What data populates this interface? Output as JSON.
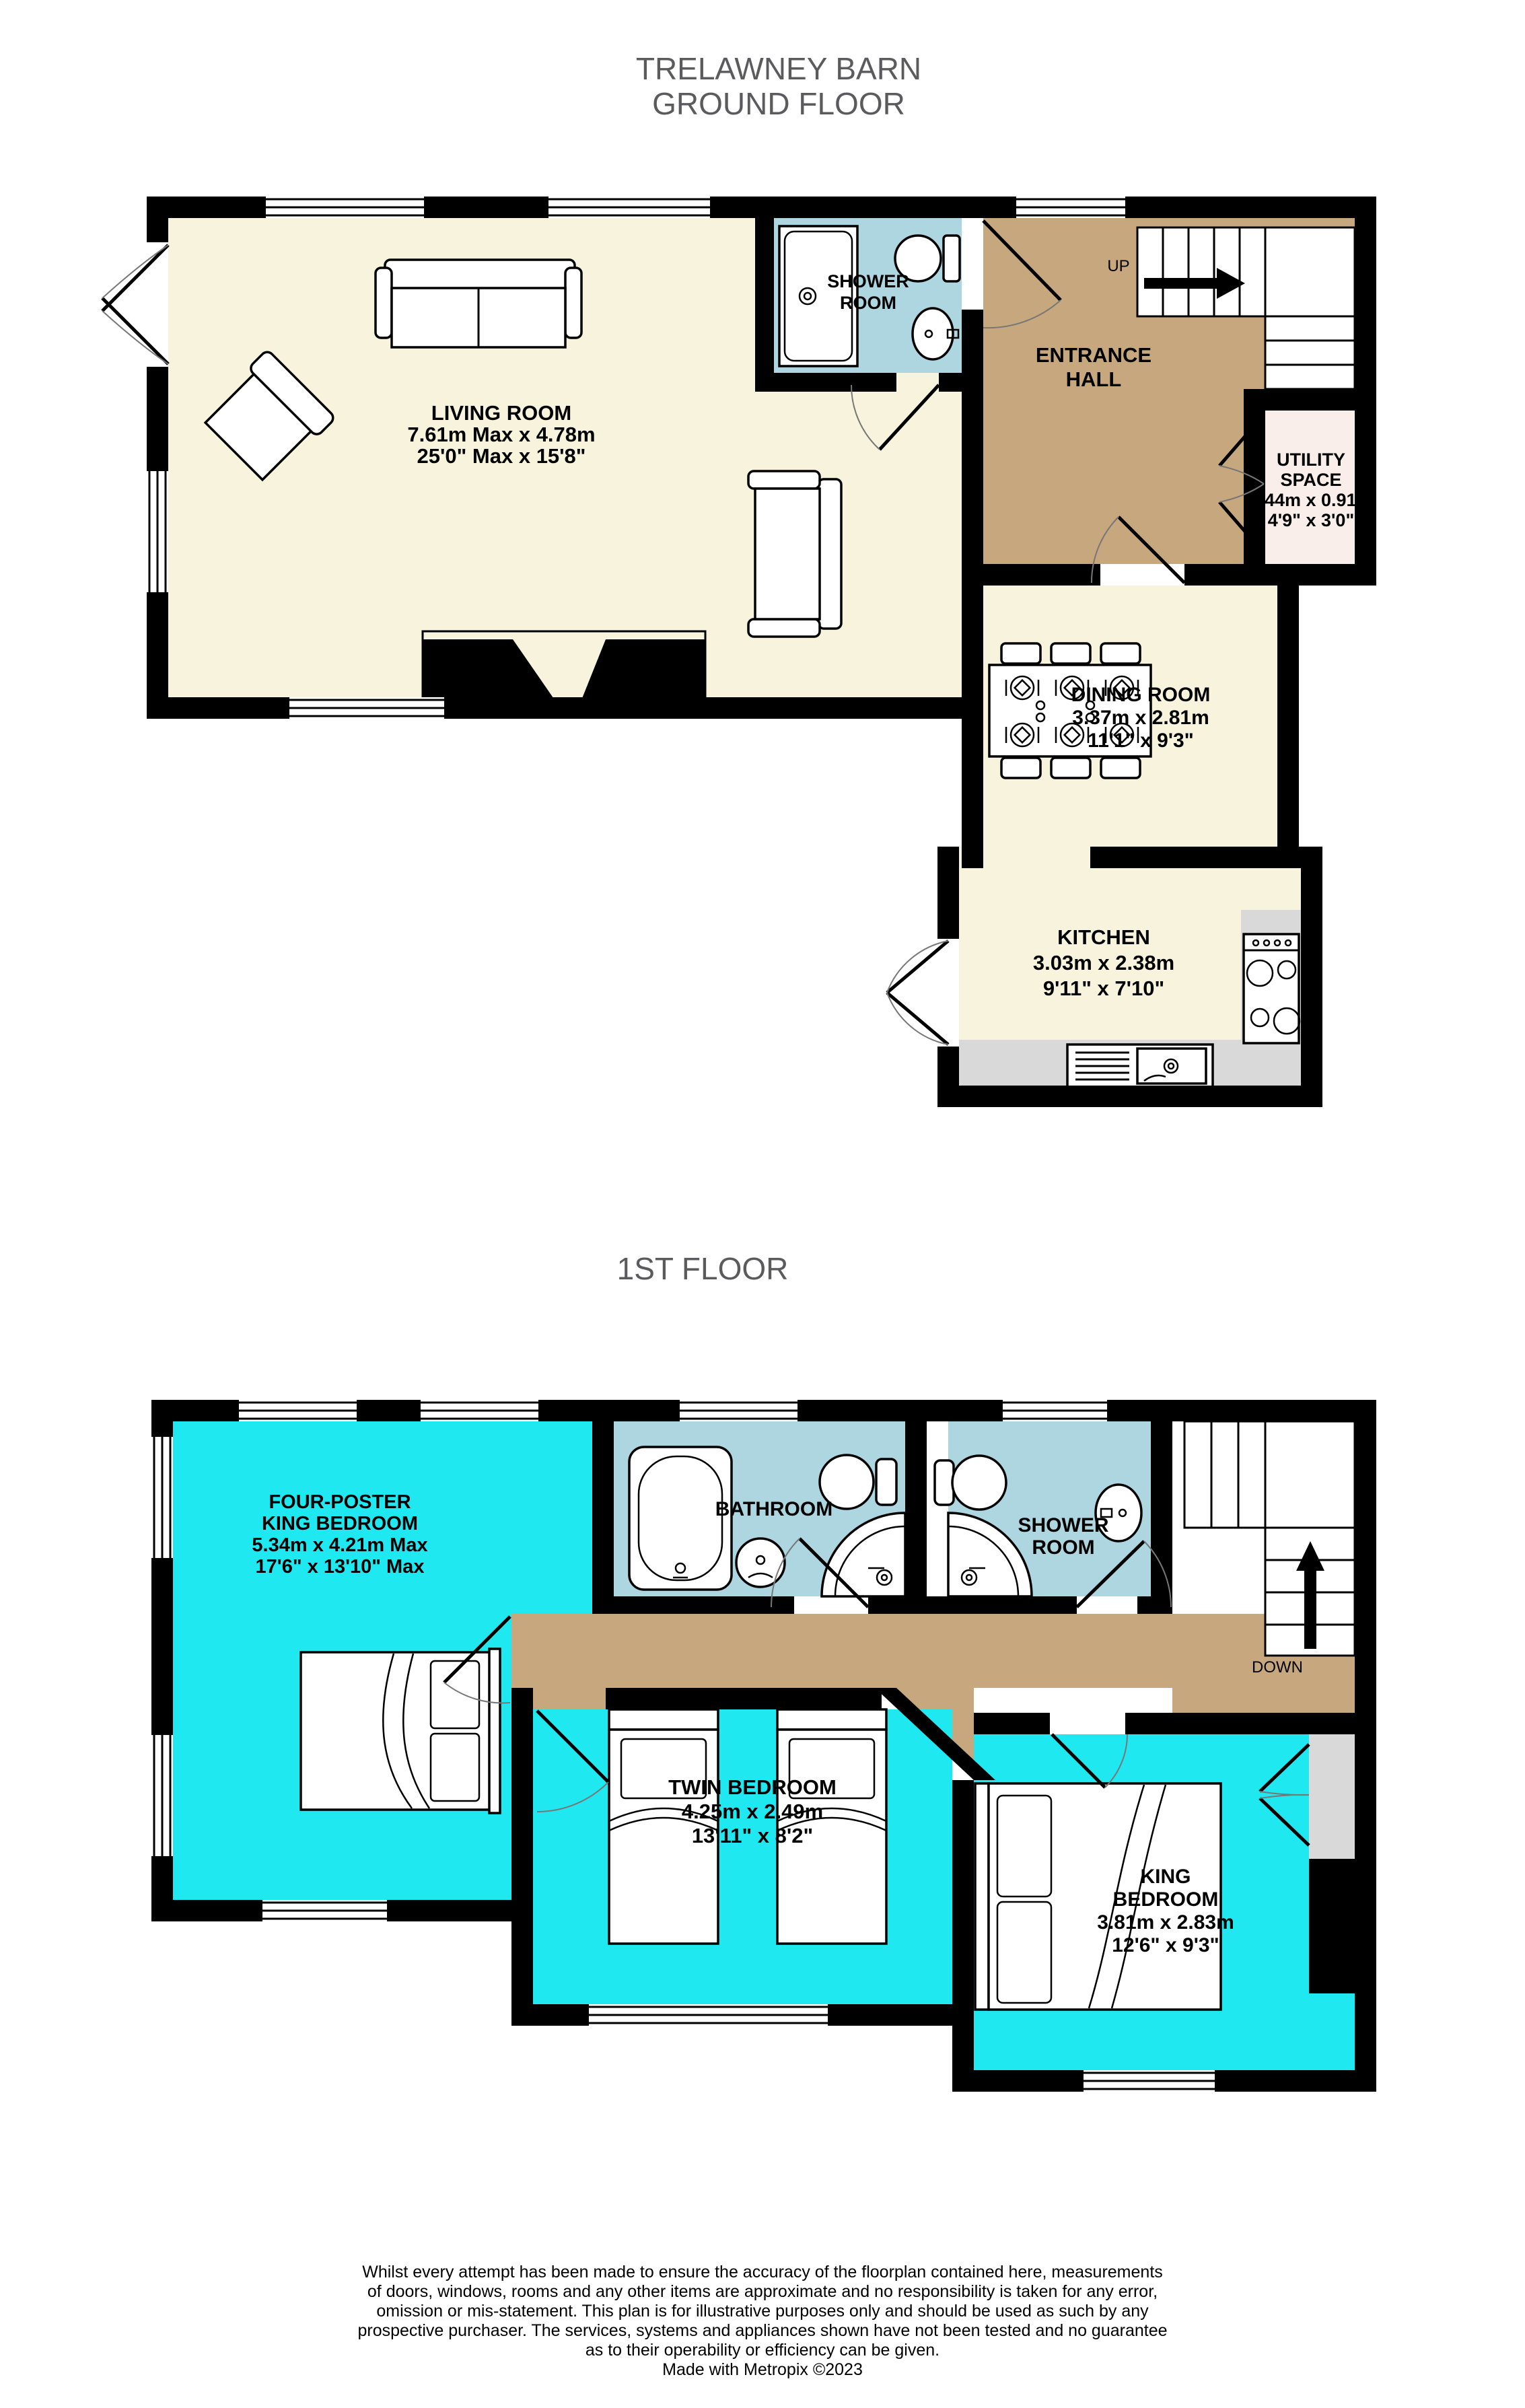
{
  "page": {
    "title_line1": "TRELAWNEY BARN",
    "title_line2": "GROUND FLOOR",
    "floor2_title": "1ST FLOOR"
  },
  "colors": {
    "cream": "#F8F3DC",
    "tan": "#C7A77D",
    "lightblue": "#AED6E0",
    "cyan": "#1FE8F0",
    "pink": "#F9EEE9",
    "counter_gray": "#D9D9D9",
    "title_gray": "#5B5B5D",
    "wall": "#000000"
  },
  "ground": {
    "living": {
      "name": "LIVING ROOM",
      "dim_m": "7.61m Max x 4.78m",
      "dim_ft": "25'0\" Max x 15'8\""
    },
    "shower": {
      "name1": "SHOWER",
      "name2": "ROOM"
    },
    "hall": {
      "name1": "ENTRANCE",
      "name2": "HALL",
      "up": "UP"
    },
    "utility": {
      "name1": "UTILITY",
      "name2": "SPACE",
      "dim_m": "1.44m x 0.91m",
      "dim_ft": "4'9\" x 3'0\""
    },
    "dining": {
      "name": "DINING ROOM",
      "dim_m": "3.37m x 2.81m",
      "dim_ft": "11'1\" x 9'3\""
    },
    "kitchen": {
      "name": "KITCHEN",
      "dim_m": "3.03m x 2.38m",
      "dim_ft": "9'11\" x 7'10\""
    }
  },
  "first": {
    "four_poster": {
      "name1": "FOUR-POSTER",
      "name2": "KING BEDROOM",
      "dim_m": "5.34m x 4.21m Max",
      "dim_ft": "17'6\" x 13'10\" Max"
    },
    "bathroom": {
      "name": "BATHROOM"
    },
    "shower": {
      "name1": "SHOWER",
      "name2": "ROOM"
    },
    "twin": {
      "name": "TWIN BEDROOM",
      "dim_m": "4.25m x 2.49m",
      "dim_ft": "13'11\" x 8'2\""
    },
    "king": {
      "name1": "KING",
      "name2": "BEDROOM",
      "dim_m": "3.81m x 2.83m",
      "dim_ft": "12'6\" x 9'3\""
    },
    "down": "DOWN"
  },
  "footer": {
    "lines": [
      "Whilst every attempt has been made to ensure the accuracy of the floorplan contained here, measurements",
      "of doors, windows, rooms and any other items are approximate and no responsibility is taken for any error,",
      "omission or mis-statement. This plan is for illustrative purposes only and should be used as such by any",
      "prospective purchaser. The services, systems and appliances shown have not been tested and no guarantee",
      "as to their operability or efficiency can be given.",
      "Made with Metropix ©2023"
    ]
  }
}
